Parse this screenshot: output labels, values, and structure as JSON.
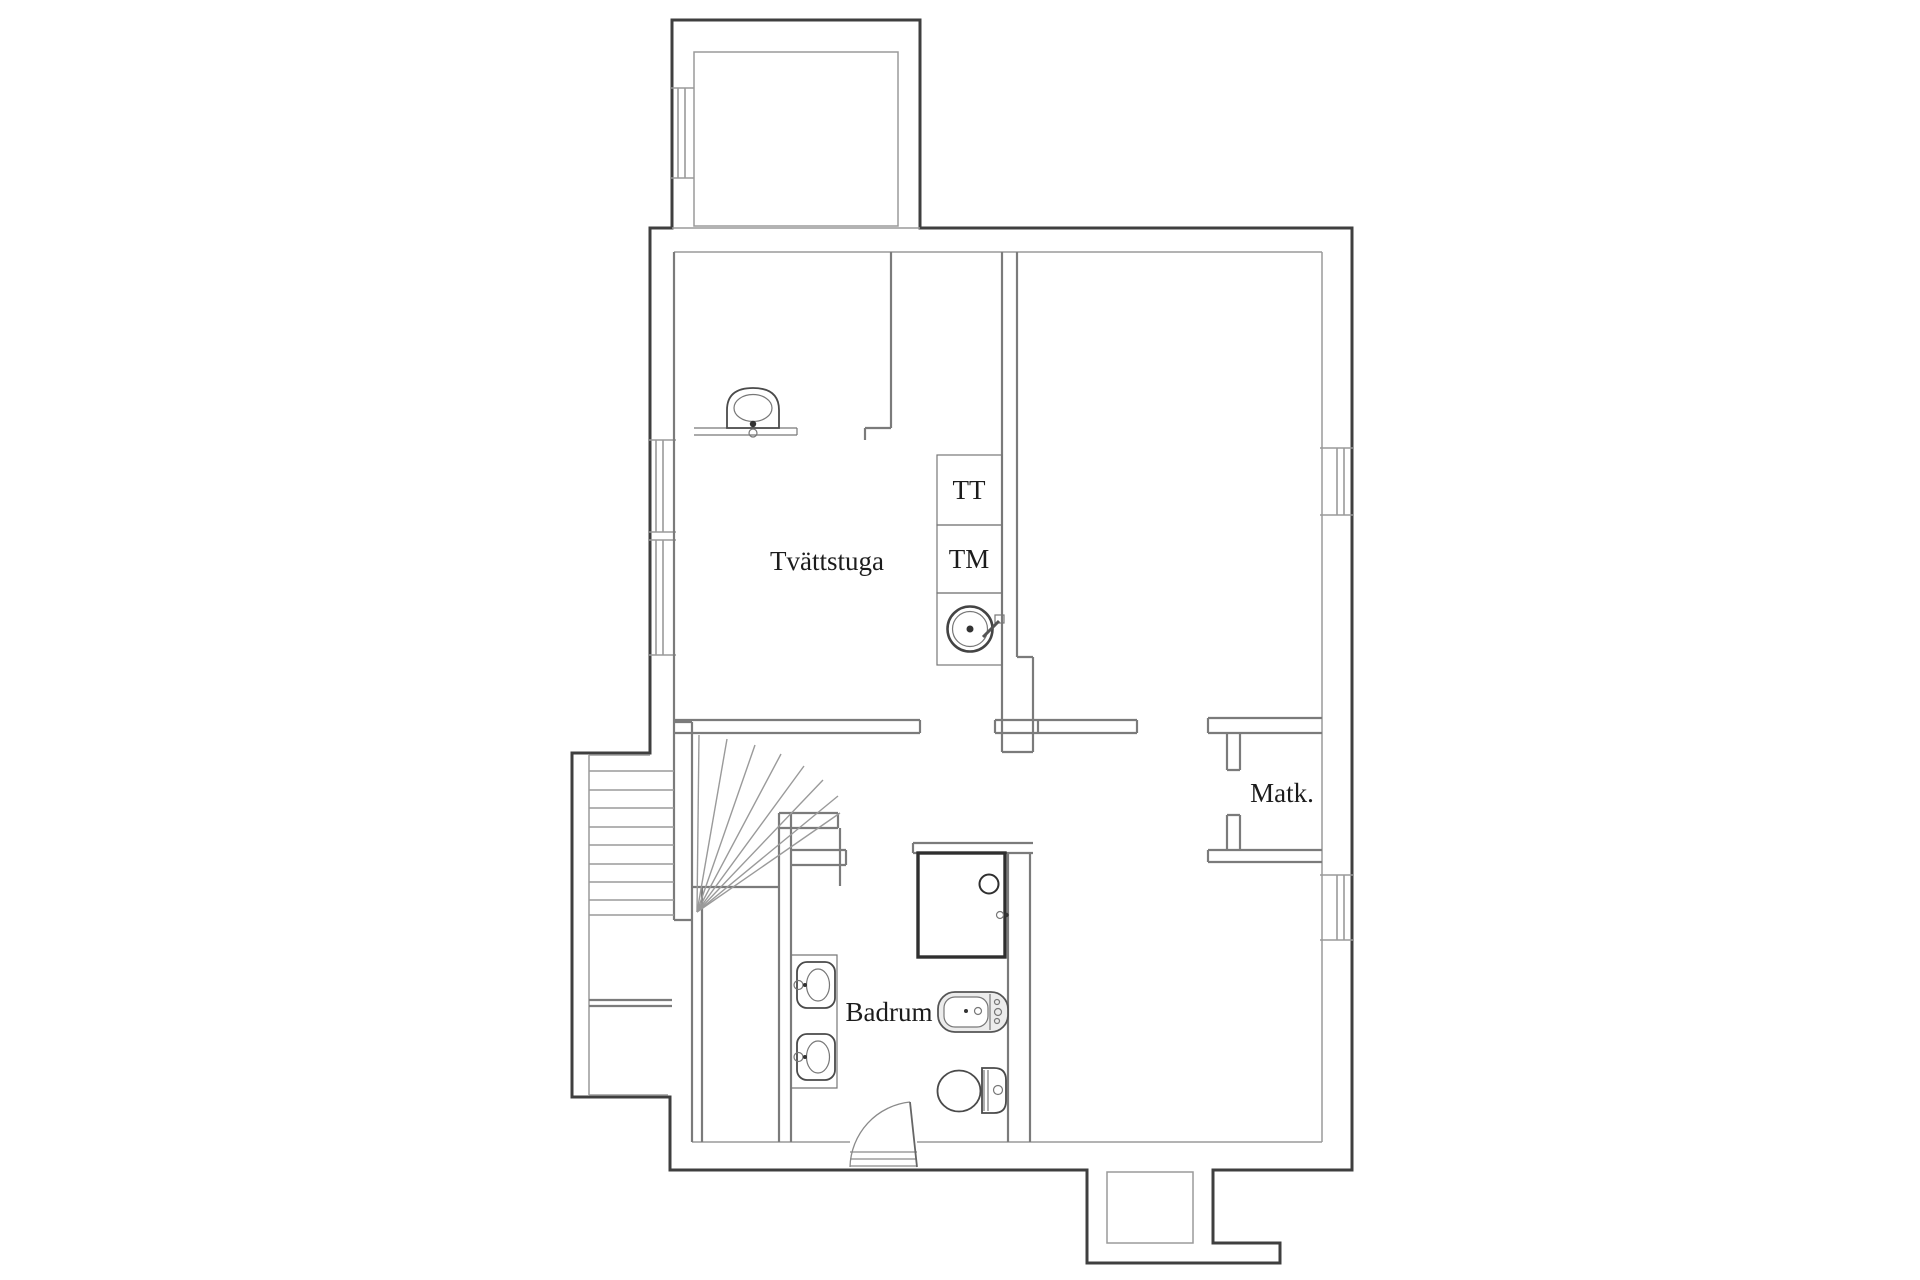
{
  "plan": {
    "title": "Basement floor plan",
    "rooms": {
      "laundry": {
        "label": "Tvättstuga"
      },
      "pantry": {
        "label": "Matk."
      },
      "bathroom": {
        "label": "Badrum"
      }
    },
    "appliances": {
      "dryer": {
        "label": "TT"
      },
      "washer": {
        "label": "TM"
      }
    },
    "fixtures": [
      "wall-basin-icon",
      "laundry-sink-icon",
      "shower-cabin-icon",
      "washbasin-icon",
      "bathtub-icon",
      "toilet-icon",
      "winder-staircase-icon",
      "straight-stairs-icon",
      "door-swing-icon",
      "window-icon"
    ],
    "colors": {
      "background": "#ffffff",
      "wall_outer": "#3f3f3f",
      "wall_inner": "#9a9a9a",
      "wall_interior": "#7b7b7b",
      "fixture_line": "#4a4a4a",
      "fixture_fill": "#ececec",
      "label": "#1c1c1c"
    }
  }
}
